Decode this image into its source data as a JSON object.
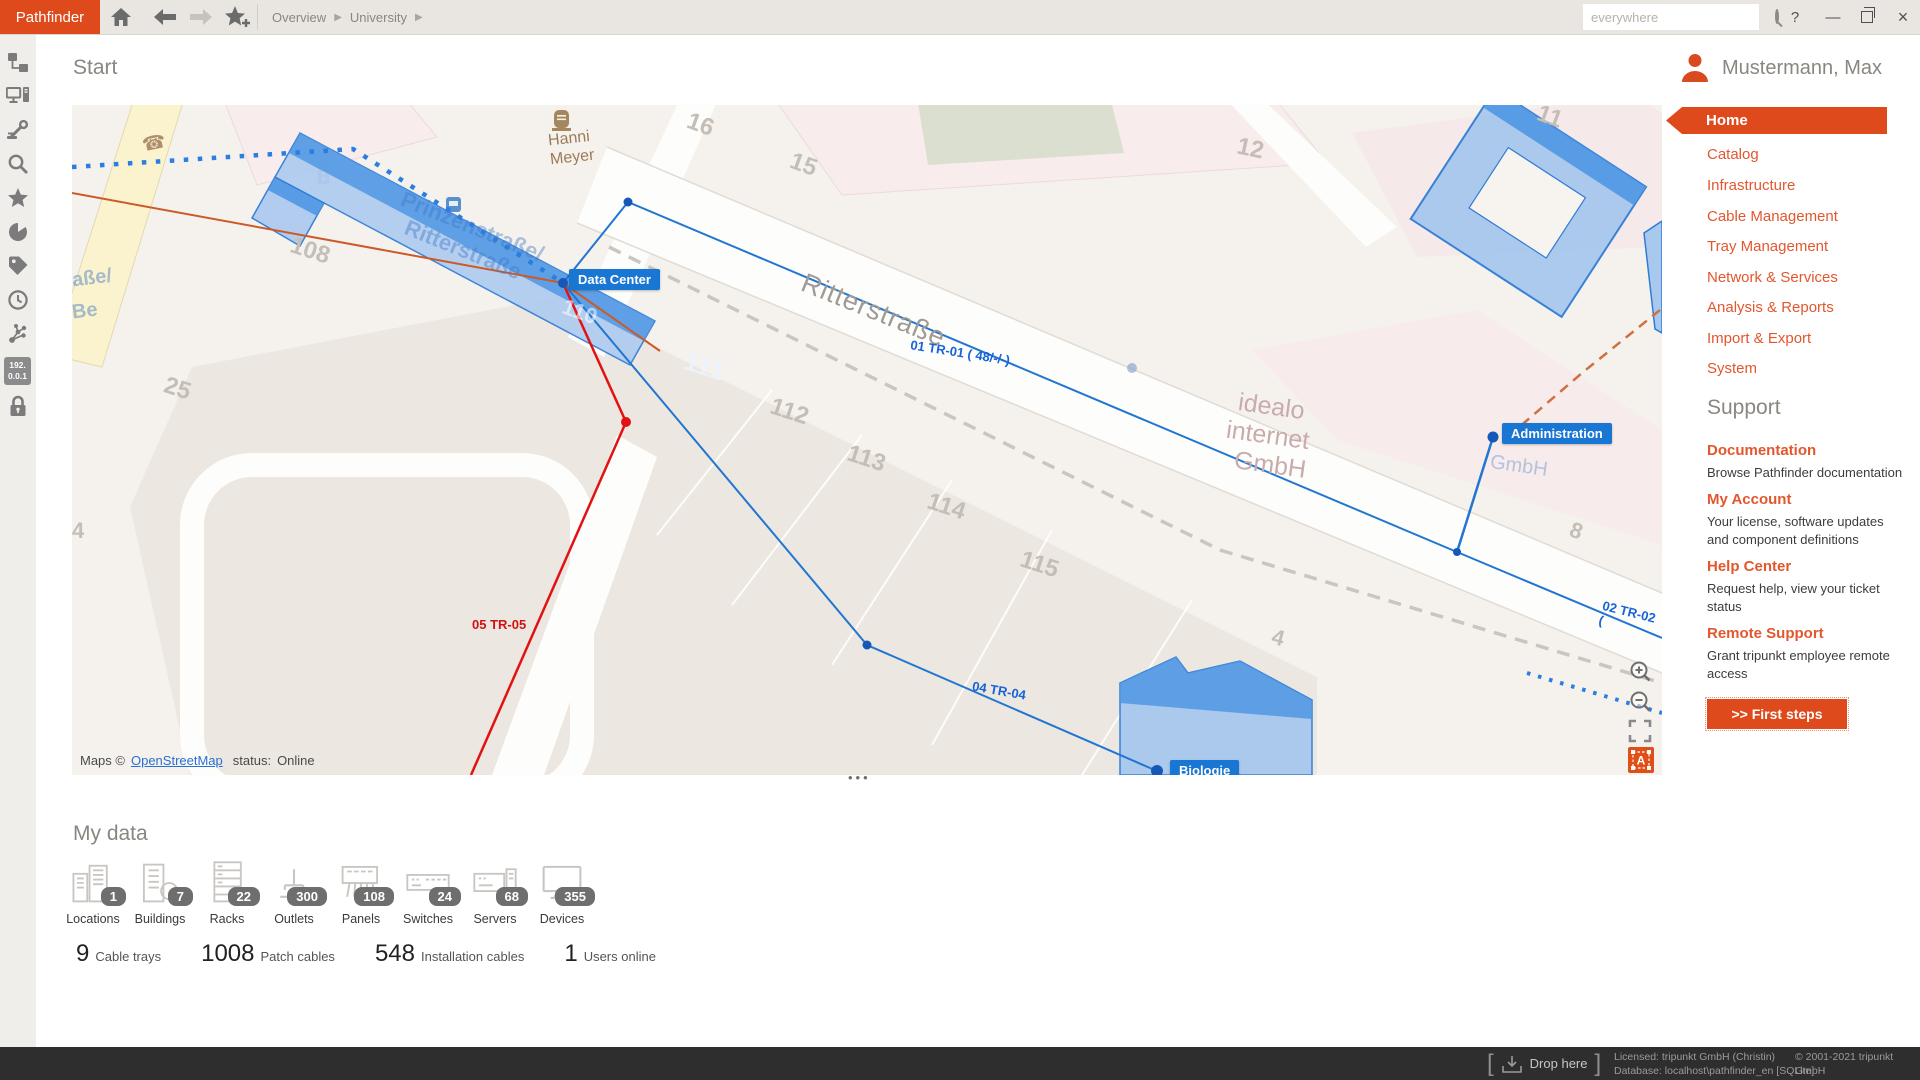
{
  "top_bar": {
    "logo": "Pathfinder",
    "breadcrumb": [
      "Overview",
      "University"
    ],
    "search_placeholder": "everywhere",
    "help_label": "?",
    "icons": [
      "home-icon",
      "back-icon",
      "forward-icon",
      "add-favorite-icon",
      "search-icon",
      "minimize-icon",
      "restore-icon",
      "close-icon"
    ]
  },
  "left_rail": {
    "icons": [
      "tree-icon",
      "workstation-icon",
      "tools-icon",
      "search-icon",
      "favorites-icon",
      "pie-chart-icon",
      "tags-icon",
      "history-icon",
      "topology-icon",
      "ip-address-icon",
      "lock-icon"
    ],
    "ip_badge_line1": "192.",
    "ip_badge_line2": "0.0.1"
  },
  "page": {
    "title": "Start"
  },
  "map": {
    "badges": {
      "data_center": "Data Center",
      "administration": "Administration",
      "biologie": "Biologie"
    },
    "cable_labels": {
      "tr01": "01 TR-01 ( 48/-/-)",
      "tr02": "02 TR-02 (",
      "tr04": "04 TR-04",
      "tr05": "05 TR-05"
    },
    "streets": {
      "main": "Ritterstraße",
      "secondary_line1": "Prinzenstraße/",
      "secondary_line2": "Ritterstraße",
      "edge_line1": "aße/",
      "edge_line2": "Be"
    },
    "pois": {
      "hanni_line1": "Hanni",
      "hanni_line2": "Meyer",
      "idealo_line1": "idealo",
      "idealo_line2": "internet",
      "idealo_line3": "GmbH",
      "gmbh": "GmbH"
    },
    "house_numbers": {
      "n16": "16",
      "n15": "15",
      "n12": "12",
      "n11": "11",
      "n108": "108",
      "n110": "110",
      "n111": "111",
      "n112": "112",
      "n113": "113",
      "n114": "114",
      "n115": "115",
      "n4": "4",
      "n8": "8",
      "n25": "25",
      "n4b": "4"
    },
    "attribution": {
      "prefix": "Maps ©",
      "link": "OpenStreetMap",
      "status_label": "status:",
      "status_value": "Online"
    },
    "overflow_handle": "•••",
    "controls": [
      "zoom-in-icon",
      "zoom-out-icon",
      "fullscreen-icon",
      "labels-toggle-icon"
    ],
    "labels_toggle_letter": "A"
  },
  "sidebar": {
    "user": "Mustermann, Max",
    "menu": [
      {
        "label": "Home",
        "selected": true
      },
      {
        "label": "Catalog"
      },
      {
        "label": "Infrastructure"
      },
      {
        "label": "Cable Management"
      },
      {
        "label": "Tray Management"
      },
      {
        "label": "Network & Services"
      },
      {
        "label": "Analysis & Reports"
      },
      {
        "label": "Import & Export"
      },
      {
        "label": "System"
      }
    ],
    "support": {
      "title": "Support",
      "items": [
        {
          "label": "Documentation",
          "desc": "Browse Pathfinder documentation"
        },
        {
          "label": "My Account",
          "desc": "Your license, software updates and component definitions"
        },
        {
          "label": "Help Center",
          "desc": "Request help, view your ticket status"
        },
        {
          "label": "Remote Support",
          "desc": "Grant tripunkt employee remote access"
        }
      ],
      "first_steps": ">> First steps"
    }
  },
  "my_data": {
    "title": "My data",
    "items": [
      {
        "label": "Locations",
        "count": "1",
        "icon": "locations-icon"
      },
      {
        "label": "Buildings",
        "count": "7",
        "icon": "buildings-icon"
      },
      {
        "label": "Racks",
        "count": "22",
        "icon": "racks-icon"
      },
      {
        "label": "Outlets",
        "count": "300",
        "icon": "outlets-icon"
      },
      {
        "label": "Panels",
        "count": "108",
        "icon": "panels-icon"
      },
      {
        "label": "Switches",
        "count": "24",
        "icon": "switches-icon"
      },
      {
        "label": "Servers",
        "count": "68",
        "icon": "servers-icon"
      },
      {
        "label": "Devices",
        "count": "355",
        "icon": "devices-icon"
      }
    ],
    "stats": [
      {
        "value": "9",
        "label": "Cable trays"
      },
      {
        "value": "1008",
        "label": "Patch cables"
      },
      {
        "value": "548",
        "label": "Installation cables"
      },
      {
        "value": "1",
        "label": "Users online"
      }
    ]
  },
  "status_bar": {
    "drop_here": "Drop here",
    "licensed": "Licensed: tripunkt GmbH (Christin)",
    "database": "Database: localhost\\pathfinder_en [SQLite]",
    "copyright": "© 2001-2021 tripunkt GmbH",
    "version": "v3.3.2.459 (64 Bit)"
  },
  "colors": {
    "accent": "#df4a1d",
    "map_blue": "#1976d2",
    "cable_red": "#e31212",
    "cable_orange": "#cc5a28",
    "status_bg": "#2e2e2e"
  }
}
